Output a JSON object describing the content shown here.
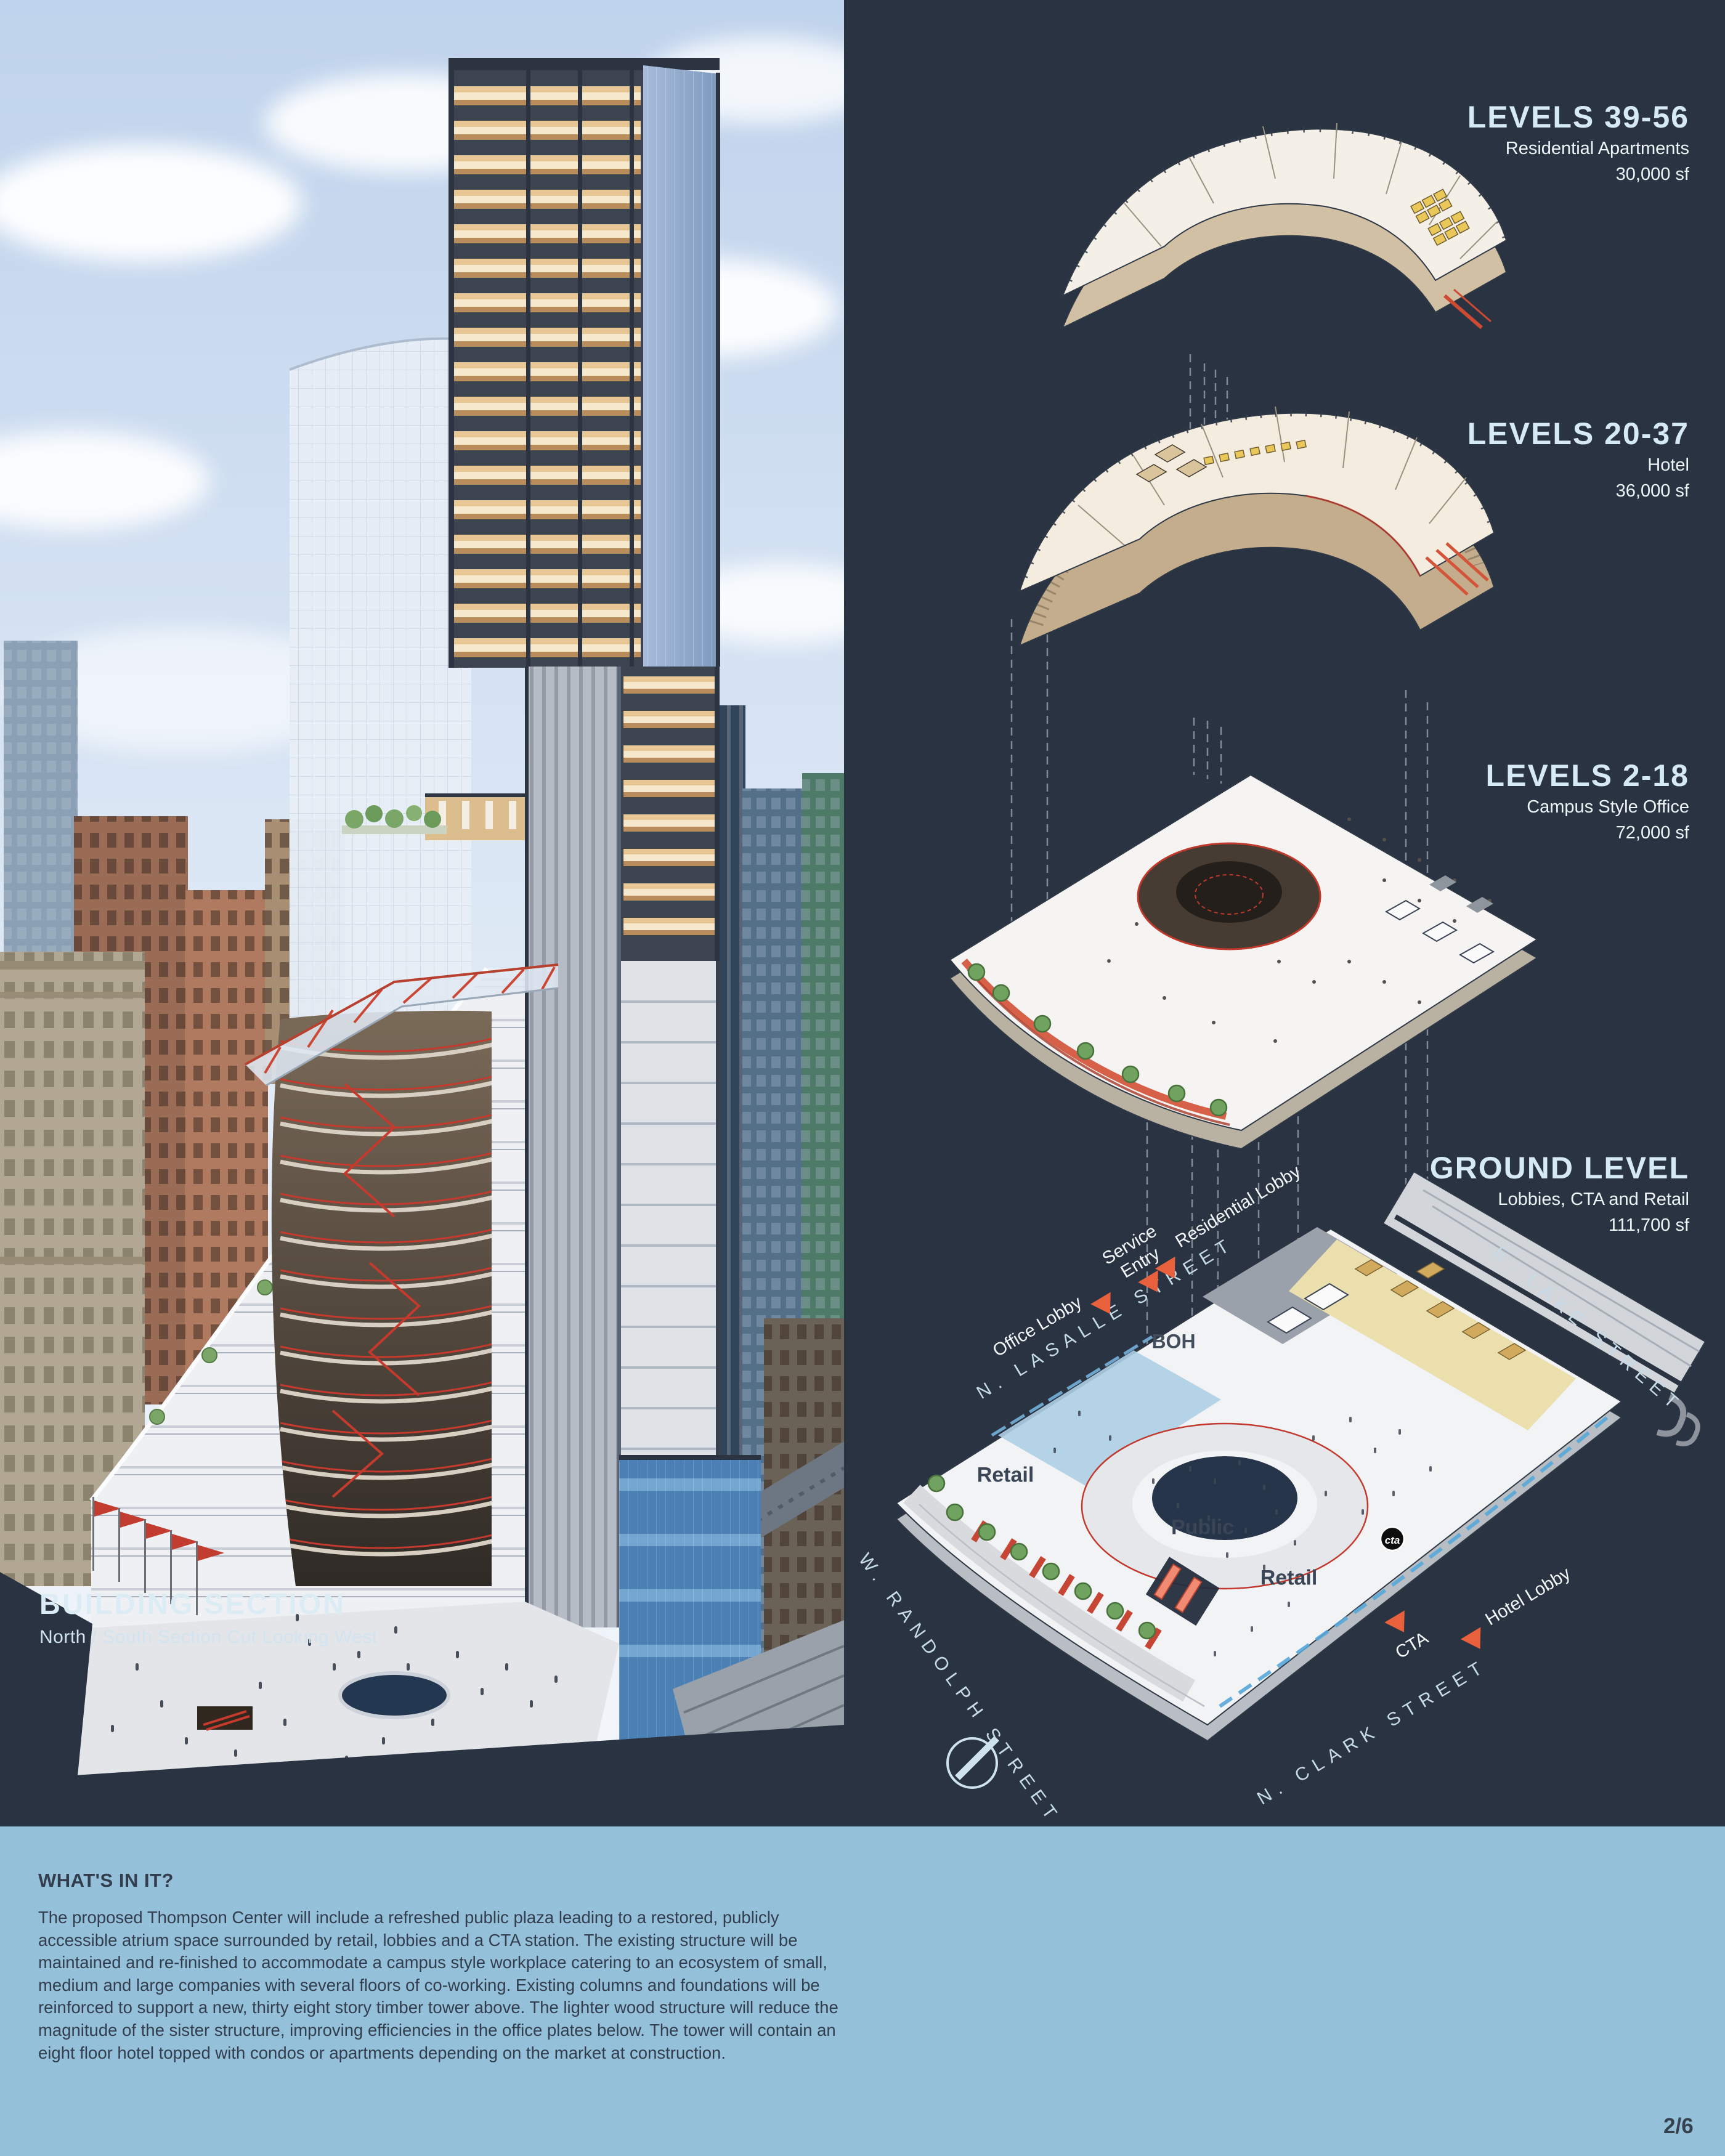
{
  "building_section": {
    "title": "BUILDING SECTION",
    "subtitle": "North / South Section Cut Looking West"
  },
  "levels": [
    {
      "title": "LEVELS 39-56",
      "use": "Residential Apartments",
      "area": "30,000 sf"
    },
    {
      "title": "LEVELS 20-37",
      "use": "Hotel",
      "area": "36,000 sf"
    },
    {
      "title": "LEVELS 2-18",
      "use": "Campus Style Office",
      "area": "72,000 sf"
    },
    {
      "title": "GROUND LEVEL",
      "use": "Lobbies, CTA and Retail",
      "area": "111,700 sf"
    }
  ],
  "streets": {
    "lasalle": "N. LASALLE STREET",
    "lake": "E. LAKE STREET",
    "randolph": "W. RANDOLPH STREET",
    "clark": "N. CLARK STREET"
  },
  "ground_labels": {
    "office_lobby": "Office Lobby",
    "service_entry": "Service\nEntry",
    "residential_lobby": "Residential Lobby",
    "boh": "BOH",
    "retail_west": "Retail",
    "public": "Public",
    "retail_east": "Retail",
    "cta": "CTA",
    "hotel_lobby": "Hotel Lobby",
    "cta_logo": "cta"
  },
  "whats_in_it": {
    "heading": "WHAT'S IN IT?",
    "body": "The proposed Thompson Center will include a refreshed public plaza leading to a restored, publicly accessible atrium space surrounded by retail, lobbies and a CTA station. The existing structure will be maintained and re-finished to accommodate a campus style workplace catering to an ecosystem of small, medium and large companies with several floors of co-working. Existing columns and foundations will be reinforced to support a new, thirty eight story timber tower above. The lighter wood structure will reduce the magnitude of the sister structure, improving efficiencies in the office plates below. The tower will contain an eight floor hotel topped with condos or apartments depending on the market at construction."
  },
  "page_number": "2/6",
  "colors": {
    "background_dark": "#2a3342",
    "background_light_blue": "#95c0d9",
    "title_blue": "#d5eaf4",
    "arrow_orange": "#e8603c",
    "accent_red": "#c6392d",
    "timber_tan": "#e9c795"
  }
}
